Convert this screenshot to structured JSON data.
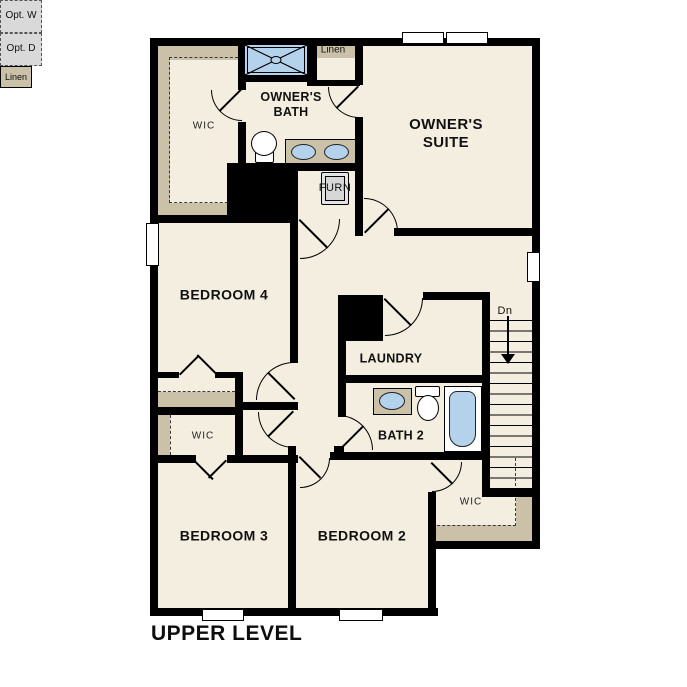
{
  "title": "UPPER LEVEL",
  "rooms": {
    "owners_suite": "OWNER'S\nSUITE",
    "owners_bath": "OWNER'S\nBATH",
    "bedroom_4": "BEDROOM 4",
    "bedroom_3": "BEDROOM 3",
    "bedroom_2": "BEDROOM 2",
    "laundry": "LAUNDRY",
    "bath_2": "BATH 2"
  },
  "closets": {
    "owners_wic": "WIC",
    "bedroom3_wic": "WIC",
    "bedroom2_wic": "WIC",
    "linen_hall": "Linen",
    "linen_bath": "Linen"
  },
  "equipment": {
    "furnace": "FURN",
    "washer_optional": "Opt.\nW",
    "dryer_optional": "Opt.\nD"
  },
  "stairs": {
    "down_label": "Dn"
  },
  "colors": {
    "floor": "#f4eee0",
    "closet_tan": "#cbc0a8",
    "fixture_blue": "#b4d2ec",
    "wall": "#000000",
    "optional_gray": "#d9d9d9"
  }
}
